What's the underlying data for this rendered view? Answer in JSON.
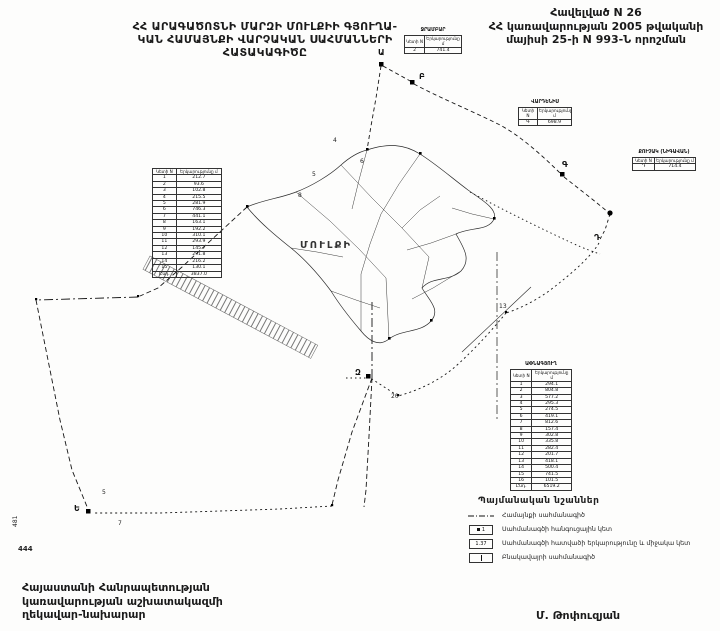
{
  "header": {
    "title_line1": "ՀՀ ԱՐԱԳԱԾՈՏՆԻ ՄԱՐԶԻ ՄՈՒԼՔԻԻ ԳՅՈՒՂԱ-",
    "title_line2": "ԿԱՆ ՀԱՄԱՅՆՔԻ ՎԱՐՉԱԿԱՆ ՍԱՀՄԱՆՆԵՐԻ",
    "title_line3": "ՀԱՏԱԿԱԳԻԾԸ",
    "annex_line1": "Հավելված N 26",
    "annex_line2": "ՀՀ կառավարության 2005 թվականի",
    "annex_line3": "մայիսի 25-ի N 993-Ն որոշման"
  },
  "map": {
    "village_label": "ՄՈՒԼՔԻ",
    "labels": {
      "a": "Ա",
      "b": "Բ",
      "g": "Գ",
      "d": "Դ",
      "e": "Ե",
      "z": "Զ"
    },
    "numbers": {
      "n4": "4",
      "n5": "5",
      "n6": "6",
      "n8": "8",
      "n13": "13",
      "n20": "20",
      "n5b": "5",
      "n7": "7"
    }
  },
  "tables": {
    "col_point": "Կետի N",
    "col_length": "Երկարությունը մ",
    "top": {
      "title": "ՋՐԱՄԲԱՐ",
      "rows": [
        {
          "n": "2",
          "l": "741.4"
        }
      ]
    },
    "right_upper": {
      "title": "ՎԱՐԴԵՆԻՍ",
      "rows": [
        {
          "n": "Գ",
          "l": "698.9"
        }
      ]
    },
    "far_right": {
      "title": "ՔՈՒՉԱԿ (ՆԻԳԱՎԱՆ)",
      "rows": [
        {
          "n": "Դ",
          "l": "714.4"
        }
      ]
    },
    "left": {
      "rows": [
        {
          "n": "1",
          "l": "212.7"
        },
        {
          "n": "2",
          "l": "93.6"
        },
        {
          "n": "3",
          "l": "102.8"
        },
        {
          "n": "4",
          "l": "215.5"
        },
        {
          "n": "5",
          "l": "281.9"
        },
        {
          "n": "6",
          "l": "746.3"
        },
        {
          "n": "7",
          "l": "441.1"
        },
        {
          "n": "8",
          "l": "163.1"
        },
        {
          "n": "9",
          "l": "192.2"
        },
        {
          "n": "10",
          "l": "310.1"
        },
        {
          "n": "11",
          "l": "293.9"
        },
        {
          "n": "12",
          "l": "145.7"
        },
        {
          "n": "13",
          "l": "291.8"
        },
        {
          "n": "14",
          "l": "216.2"
        },
        {
          "n": "15",
          "l": "130.1"
        },
        {
          "n": "Ընդ.",
          "l": "3837.0"
        }
      ]
    },
    "bottom_right": {
      "title": "ԱՓՆԱԳՅՈՒՂ",
      "rows": [
        {
          "n": "1",
          "l": "294.1"
        },
        {
          "n": "2",
          "l": "804.8"
        },
        {
          "n": "3",
          "l": "577.2"
        },
        {
          "n": "4",
          "l": "295.3"
        },
        {
          "n": "5",
          "l": "274.5"
        },
        {
          "n": "6",
          "l": "419.1"
        },
        {
          "n": "7",
          "l": "812.6"
        },
        {
          "n": "8",
          "l": "157.4"
        },
        {
          "n": "9",
          "l": "302.8"
        },
        {
          "n": "10",
          "l": "335.8"
        },
        {
          "n": "11",
          "l": "282.4"
        },
        {
          "n": "12",
          "l": "201.7"
        },
        {
          "n": "13",
          "l": "418.1"
        },
        {
          "n": "14",
          "l": "500.4"
        },
        {
          "n": "15",
          "l": "741.5"
        },
        {
          "n": "16",
          "l": "101.5"
        },
        {
          "n": "Ընդ.",
          "l": "6519.2"
        }
      ]
    }
  },
  "legend": {
    "title": "Պայմանական նշաններ",
    "items": [
      {
        "label": "Համայնքի սահմանագիծ"
      },
      {
        "box_text": "1",
        "label": "Սահմանագծի հանգուցային կետ"
      },
      {
        "box_text": "1.37",
        "label": "Սահմանագծի հատվածի երկարությունը և միջակա կետ"
      },
      {
        "label": "Բնակավայրի սահմանագիծ"
      }
    ]
  },
  "footer": {
    "line1": "Հայաստանի Հանրապետության",
    "line2": "կառավարության աշխատակազմի",
    "line3": "ղեկավար-նախարար",
    "signature": "Մ. Թոփուզյան",
    "margin_vertical": "481",
    "margin_number": "444"
  }
}
